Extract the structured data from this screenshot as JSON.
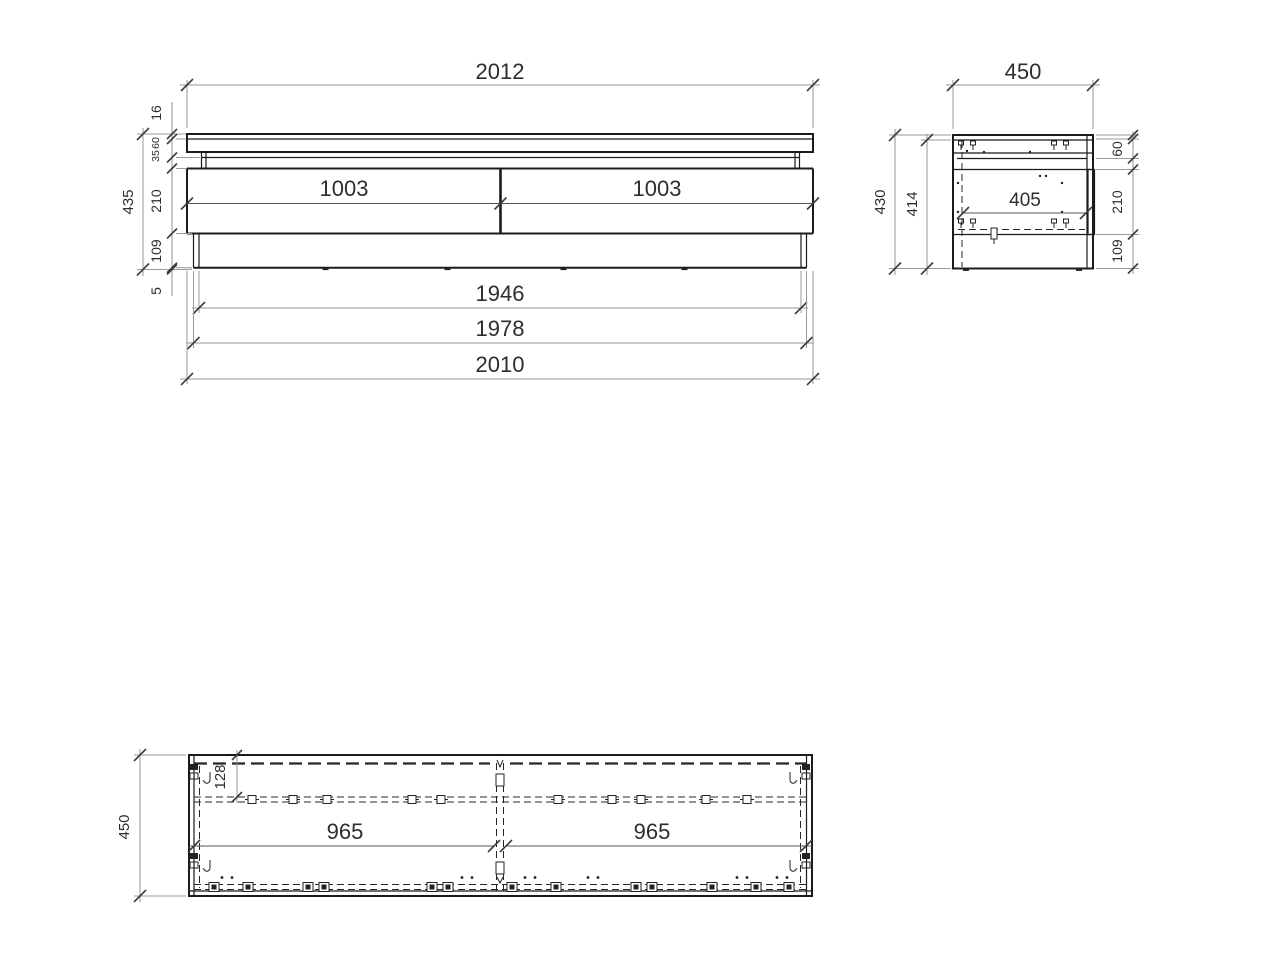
{
  "drawing": {
    "front_view": {
      "width_top": "2012",
      "top_sheet_thickness": "16",
      "top_section_height": "60",
      "rail_height": "35",
      "drawer_section_height": "210",
      "plinth_height": "109",
      "feet_height": "5",
      "overall_height": "435",
      "drawer_left_width": "1003",
      "drawer_right_width": "1003",
      "plinth_width": "1946",
      "carcass_mid_width": "1978",
      "carcass_width": "2010"
    },
    "side_view": {
      "depth": "450",
      "overall_height": "430",
      "inner_height": "414",
      "top_section_height": "60",
      "drawer_section_height": "210",
      "plinth_height": "109",
      "inner_depth": "405"
    },
    "plan_view": {
      "depth": "450",
      "rail_offset": "128",
      "left_half_width": "965",
      "right_half_width": "965"
    }
  },
  "colors": {
    "background": "#ffffff",
    "object_line": "#1b1b1b",
    "dimension_line": "#949494",
    "hidden_line": "#262626",
    "text": "#2e2e2e"
  }
}
